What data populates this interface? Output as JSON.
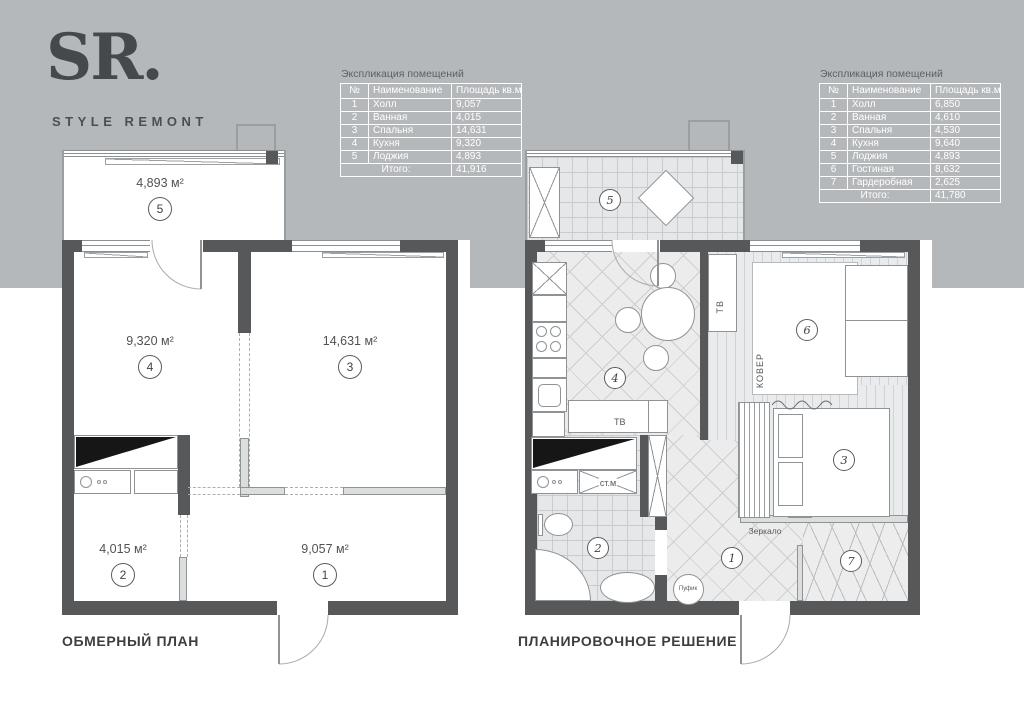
{
  "logo": {
    "title": "SR.",
    "subtitle": "STYLE REMONT"
  },
  "colors": {
    "background_top": "#b4b8bb",
    "background_bottom": "#ffffff",
    "wall": "#57585a",
    "table_text": "#ffffff",
    "text": "#46494c"
  },
  "tables": {
    "left": {
      "title": "Экспликация помещений",
      "headers": [
        "№",
        "Наименование",
        "Площадь кв.м"
      ],
      "rows": [
        [
          "1",
          "Холл",
          "9,057"
        ],
        [
          "2",
          "Ванная",
          "4,015"
        ],
        [
          "3",
          "Спальня",
          "14,631"
        ],
        [
          "4",
          "Кухня",
          "9,320"
        ],
        [
          "5",
          "Лоджия",
          "4,893"
        ]
      ],
      "total_label": "Итого:",
      "total_value": "41,916"
    },
    "right": {
      "title": "Экспликация помещений",
      "headers": [
        "№",
        "Наименование",
        "Площадь кв.м"
      ],
      "rows": [
        [
          "1",
          "Холл",
          "6,850"
        ],
        [
          "2",
          "Ванная",
          "4,610"
        ],
        [
          "3",
          "Спальня",
          "4,530"
        ],
        [
          "4",
          "Кухня",
          "9,640"
        ],
        [
          "5",
          "Лоджия",
          "4,893"
        ],
        [
          "6",
          "Гостиная",
          "8,632"
        ],
        [
          "7",
          "Гардеробная",
          "2,625"
        ]
      ],
      "total_label": "Итого:",
      "total_value": "41,780"
    }
  },
  "plans": {
    "left": {
      "title": "ОБМЕРНЫЙ ПЛАН",
      "rooms": {
        "loggia": {
          "num": "5",
          "area": "4,893 м²"
        },
        "kitchen": {
          "num": "4",
          "area": "9,320 м²"
        },
        "bedroom": {
          "num": "3",
          "area": "14,631 м²"
        },
        "bathroom": {
          "num": "2",
          "area": "4,015 м²"
        },
        "hall": {
          "num": "1",
          "area": "9,057 м²"
        }
      }
    },
    "right": {
      "title": "ПЛАНИРОВОЧНОЕ РЕШЕНИЕ",
      "numbers": {
        "loggia": "5",
        "kitchen": "4",
        "living": "6",
        "bedroom": "3",
        "bathroom": "2",
        "hall": "1",
        "wardrobe": "7"
      },
      "labels": {
        "tv_kitchen": "ТВ",
        "tv_living": "ТВ",
        "carpet": "КОВЕР",
        "mirror": "Зеркало",
        "pouf": "Пуфик",
        "washer": "ст.м"
      }
    }
  }
}
